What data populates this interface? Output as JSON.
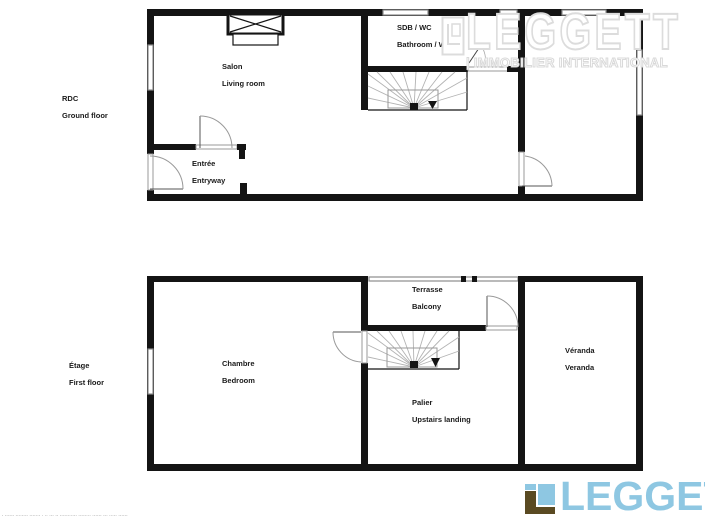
{
  "floors": {
    "ground": {
      "code": "RDC",
      "name": "Ground floor",
      "rooms": {
        "salon": {
          "fr": "Salon",
          "en": "Living room"
        },
        "bathroom": {
          "fr": "SDB / WC",
          "en": "Bathroom / WC"
        },
        "entry": {
          "fr": "Entrée",
          "en": "Entryway"
        }
      }
    },
    "first": {
      "code": "Étage",
      "name": "First floor",
      "rooms": {
        "bedroom": {
          "fr": "Chambre",
          "en": "Bedroom"
        },
        "balcony": {
          "fr": "Terrasse",
          "en": "Balcony"
        },
        "landing": {
          "fr": "Palier",
          "en": "Upstairs landing"
        },
        "veranda": {
          "fr": "Véranda",
          "en": "Veranda"
        }
      }
    }
  },
  "watermark": {
    "brand": "LEGGETT",
    "tagline": "| IMMOBILIER INTERNATIONAL"
  },
  "footer_logo": {
    "brand": "LEGGETT"
  },
  "fine_print": "- ------ -------- ------- - -- --- -- ----------- -------- ------ --- ----- ------",
  "colors": {
    "logo_blue": "#8EC7E2",
    "logo_brown": "#5A4A22",
    "wall": "#141414",
    "window_gray": "#8c8c8c"
  }
}
